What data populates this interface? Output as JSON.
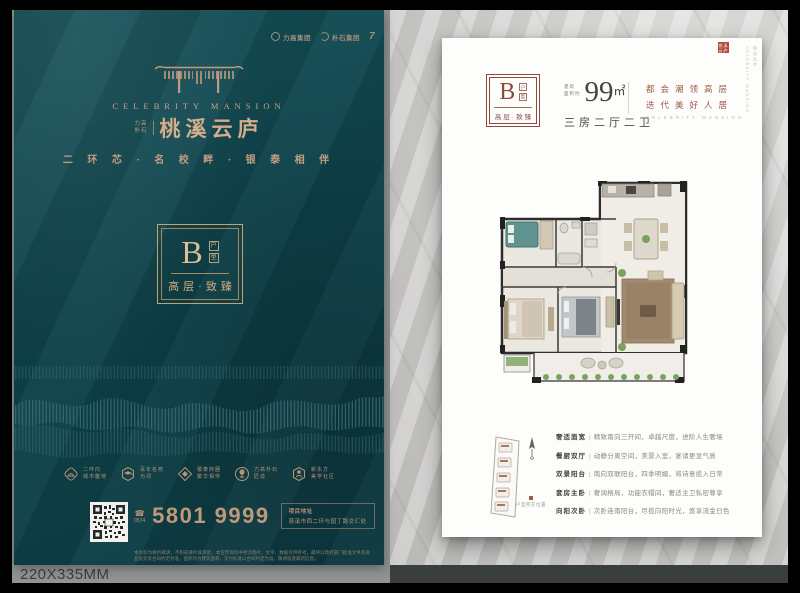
{
  "meta": {
    "size_label": "220X335MM"
  },
  "poster": {
    "logos": [
      "力高集团",
      "朴石集团",
      "7"
    ],
    "brand_en": "CELEBRITY MANSION",
    "brand_prefix_top": "力高",
    "brand_prefix_bottom": "朴石",
    "brand_cn": "桃溪云庐",
    "tagline": "二 环 芯 · 名 校 畔 · 银 泰 相 伴",
    "unit": {
      "letter": "B",
      "type_vertical": [
        "户",
        "型"
      ],
      "grade": "高层·致臻"
    },
    "features": [
      {
        "line1": "二环内",
        "line2": "城市腹地"
      },
      {
        "line1": "百年名校",
        "line2": "为邻"
      },
      {
        "line1": "银泰商圈",
        "line2": "繁华相伴"
      },
      {
        "line1": "力高朴石",
        "line2": "匠造"
      },
      {
        "line1": "新东方",
        "line2": "美学社区"
      }
    ],
    "phone": {
      "area": "0574",
      "number": "5801 9999"
    },
    "address_label": "项目地址",
    "address": "慈溪市西二环与园丁路交汇处",
    "disclaimer": "本资料为要约邀请，不构成要约或承诺。本宣传资料中所涉图片、文字、数据仅供参考，最终以政府部门批准文件及商品房买卖合同约定为准。面积均为建筑面积，交付标准以合同约定为准，敬请留意最新信息。"
  },
  "page": {
    "unit": {
      "letter": "B",
      "type_vertical": [
        "户",
        "型"
      ],
      "grade": "高层·致臻"
    },
    "area": {
      "prefix_line1": "建筑",
      "prefix_line2": "面积约",
      "value": "99",
      "unit": "㎡",
      "rooms": "三房二厅二卫"
    },
    "slogan_line1": "都会潮领高层",
    "slogan_line2": "迭代美好人居",
    "slogan_en": "CELEBRITY MANSION",
    "seal": "桃溪云庐",
    "side_text": [
      "桃溪云庐",
      "CELEBRITY MANSION"
    ],
    "legend": "户型所在位置",
    "desc_sep": "|",
    "descriptions": [
      {
        "label": "奢适面宽",
        "text": "精致南向三开间，卓越尺度，进阶人生奢境"
      },
      {
        "label": "餐厨双厅",
        "text": "动静分离空间，美景入室，宴请更显气质"
      },
      {
        "label": "双景阳台",
        "text": "南向双联阳台，四季明媚，将诗意揽入日常"
      },
      {
        "label": "套房主卧",
        "text": "奢阔格局，功能衣帽间，奢适主卫私密尊享"
      },
      {
        "label": "向阳次卧",
        "text": "次卧连南阳台，尽揽向阳时光，悠享流金日色"
      }
    ]
  }
}
